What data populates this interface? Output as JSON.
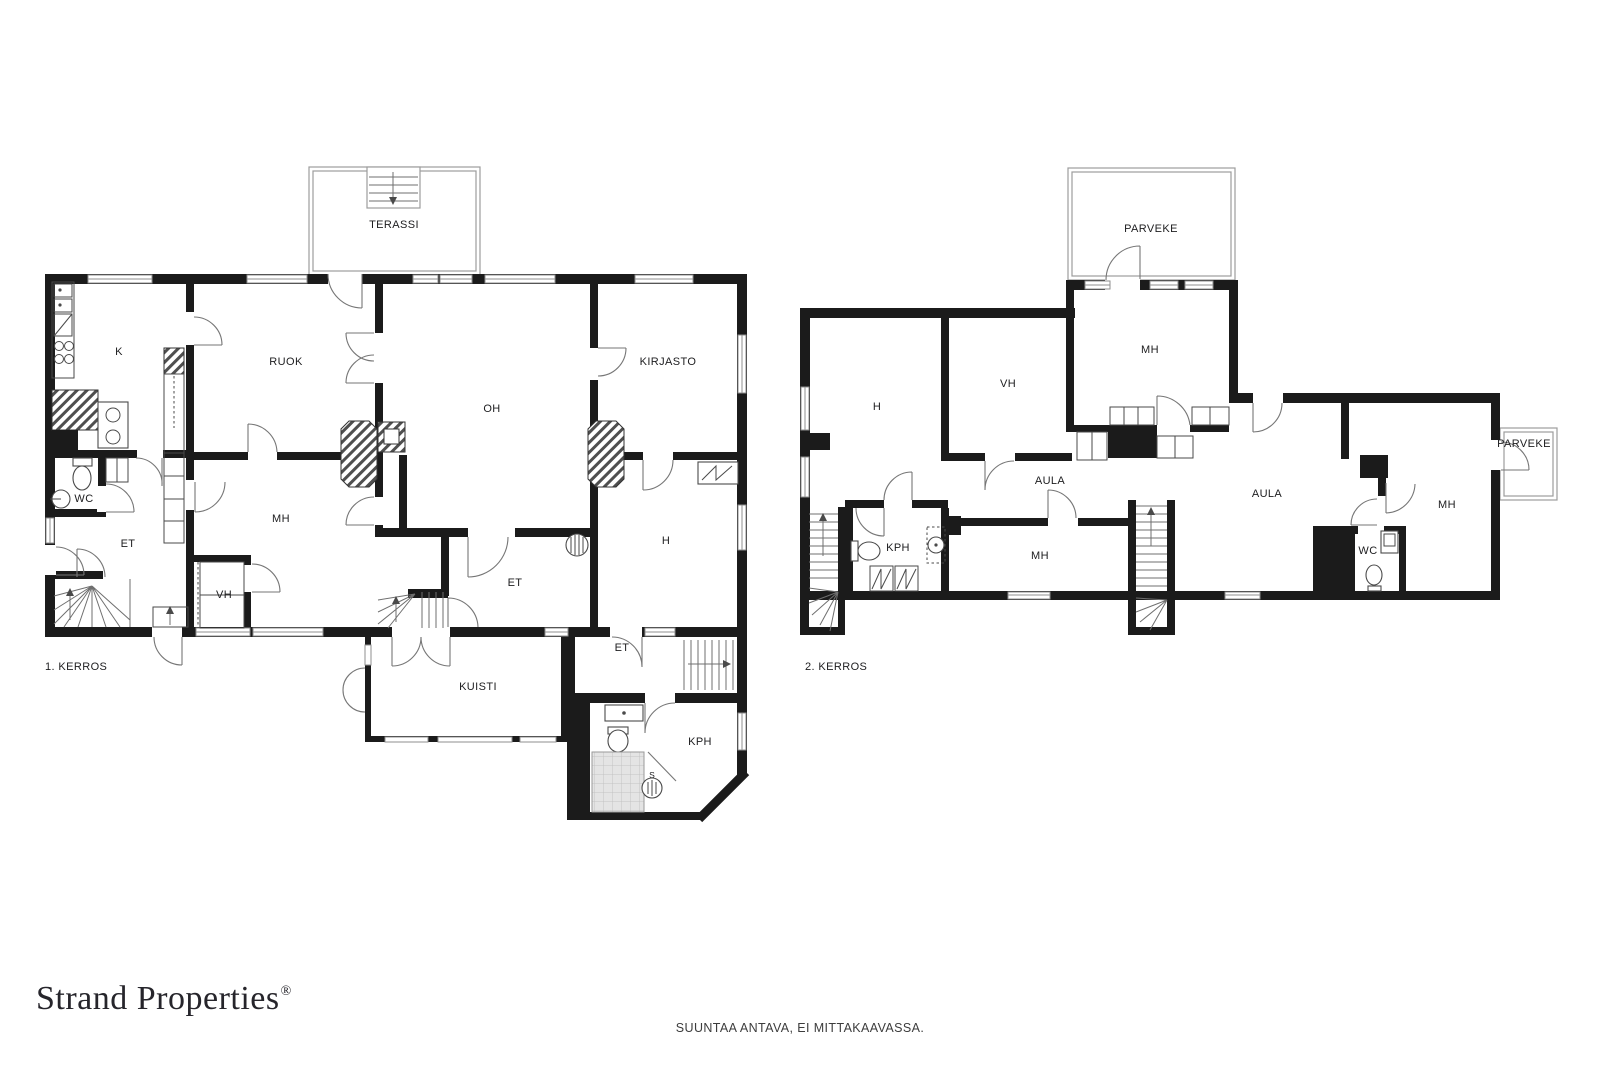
{
  "floor1": {
    "label": "1. KERROS",
    "rooms": {
      "terassi": "TERASSI",
      "k": "K",
      "ruok": "RUOK",
      "oh": "OH",
      "kirjasto": "KIRJASTO",
      "wc": "WC",
      "et_left": "ET",
      "mh": "MH",
      "vh": "VH",
      "et_center": "ET",
      "h": "H",
      "kuisti": "KUISTI",
      "et_lower": "ET",
      "kph": "KPH",
      "sauna_marker": "S"
    }
  },
  "floor2": {
    "label": "2. KERROS",
    "rooms": {
      "parveke_top": "PARVEKE",
      "mh_top": "MH",
      "h": "H",
      "vh": "VH",
      "aula_small": "AULA",
      "aula": "AULA",
      "kph": "KPH",
      "mh_center": "MH",
      "wc": "WC",
      "mh_right": "MH",
      "parveke_right": "PARVEKE"
    }
  },
  "branding": {
    "logo_text": "Strand Properties",
    "registered_mark": "®"
  },
  "footer": {
    "disclaimer": "SUUNTAA ANTAVA, EI MITTAKAAVASSA."
  }
}
